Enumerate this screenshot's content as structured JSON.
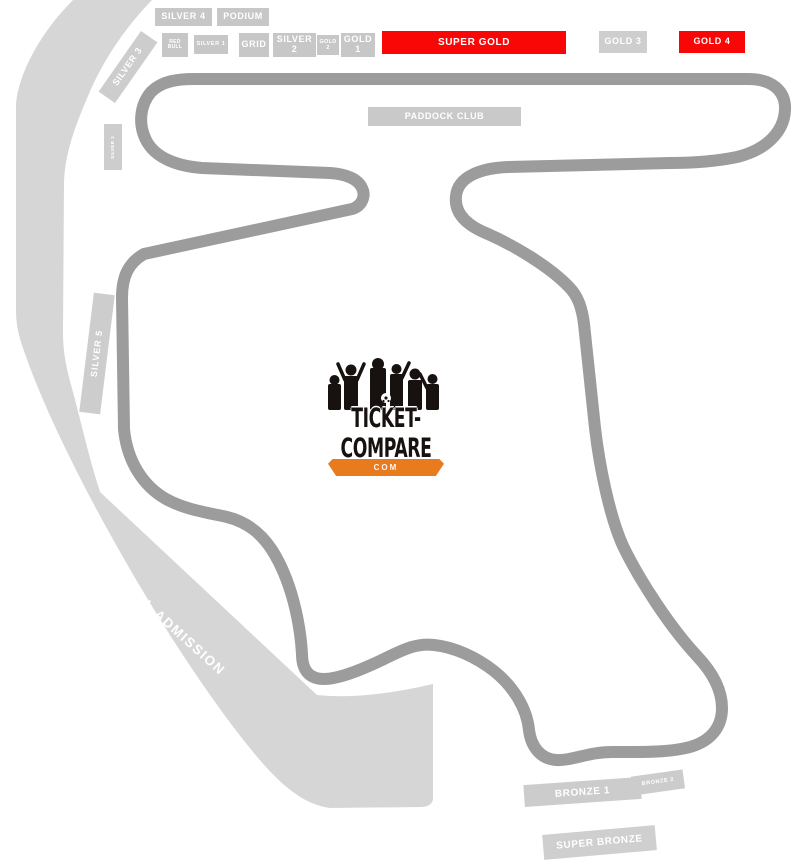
{
  "colors": {
    "track": "#9c9c9c",
    "general_admission_zone": "#d6d6d6",
    "stand_box": "#c7c7c7",
    "premium_stand": "#f90606",
    "label_text": "#ffffff",
    "logo_orange": "#e87b1e",
    "logo_black": "#171210"
  },
  "stands": {
    "silver_4": "SILVER 4",
    "podium": "PODIUM",
    "red_bull": "RED BULL",
    "silver_1": "SILVER 1",
    "grid": "GRID",
    "silver_2": "SILVER 2",
    "gold_2": "GOLD 2",
    "gold_1": "GOLD 1",
    "super_gold": "SUPER GOLD",
    "gold_3": "GOLD 3",
    "gold_4": "GOLD 4",
    "paddock_club": "PADDOCK CLUB",
    "silver_3": "SILVER 3",
    "silver_3_small": "SILVER 3",
    "silver_5": "SILVER 5",
    "general_admission": "GENERAL ADMISSION",
    "bronze_1": "BRONZE 1",
    "bronze_2": "BRONZE 2",
    "super_bronze": "SUPER BRONZE"
  },
  "logo": {
    "brand": "TICKET-COMPARE",
    "tld": "COM"
  }
}
